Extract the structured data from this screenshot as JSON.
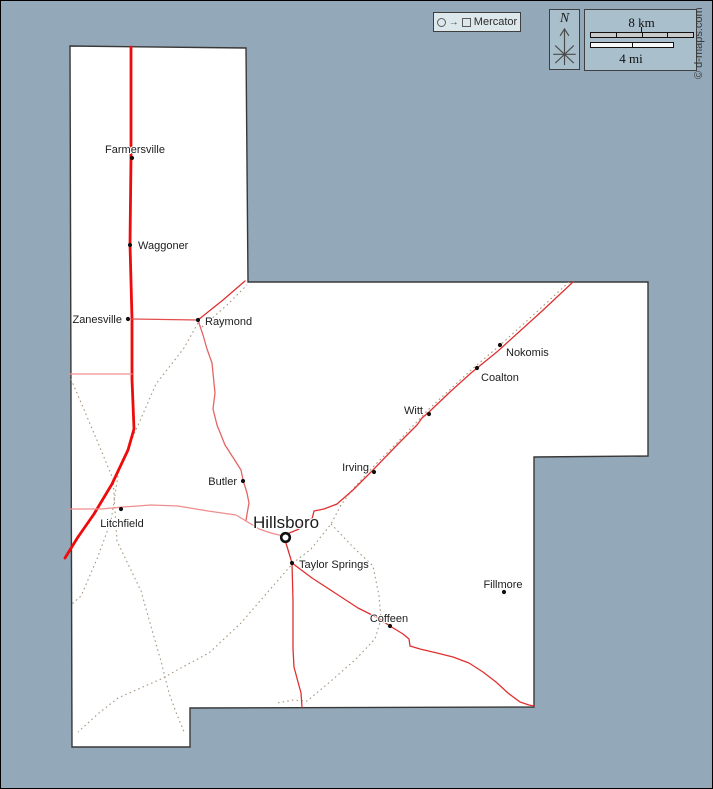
{
  "canvas": {
    "width": 713,
    "height": 789,
    "background": "#93a9b9",
    "frame_color": "#000000"
  },
  "header": {
    "projection_box": {
      "label": "Mercator",
      "icon": "circle-to-square-projection"
    },
    "compass": {
      "label": "N"
    },
    "scale": {
      "km_label": "8 km",
      "mi_label": "4 mi"
    },
    "credit": "© d-maps.com"
  },
  "map": {
    "county_fill": "#ffffff",
    "county_border_color": "#383838",
    "railroad_color": "#a8977f",
    "label_color": "#1c1c1c",
    "county_outline": [
      [
        69,
        45
      ],
      [
        245,
        47
      ],
      [
        247,
        281
      ],
      [
        647,
        281
      ],
      [
        647,
        455
      ],
      [
        533,
        456
      ],
      [
        533,
        706
      ],
      [
        189,
        707
      ],
      [
        189,
        746
      ],
      [
        71,
        746
      ]
    ],
    "roads": [
      {
        "id": "main-highway-north-south",
        "width": 2.8,
        "color": "#ed0b0b",
        "points": [
          [
            130,
            46
          ],
          [
            130,
            157
          ],
          [
            129,
            243
          ],
          [
            131,
            318
          ],
          [
            131,
            378
          ],
          [
            133,
            428
          ],
          [
            127,
            449
          ],
          [
            111,
            483
          ],
          [
            93,
            513
          ],
          [
            77,
            536
          ],
          [
            64,
            557
          ]
        ]
      },
      {
        "id": "west-connector",
        "width": 1.3,
        "color": "#ef9292",
        "points": [
          [
            68,
            373
          ],
          [
            131,
            373
          ]
        ]
      },
      {
        "id": "zanesville-raymond-road",
        "width": 1.3,
        "color": "#e34d4d",
        "points": [
          [
            131,
            318
          ],
          [
            197,
            319
          ]
        ]
      },
      {
        "id": "raymond-ne-stub",
        "width": 1.3,
        "color": "#e03030",
        "points": [
          [
            197,
            319
          ],
          [
            222,
            299
          ],
          [
            244,
            280
          ]
        ]
      },
      {
        "id": "raymond-butler-road",
        "width": 1.3,
        "color": "#e56464",
        "points": [
          [
            197,
            319
          ],
          [
            202,
            334
          ],
          [
            206,
            348
          ],
          [
            211,
            362
          ],
          [
            214,
            392
          ],
          [
            212,
            408
          ],
          [
            216,
            424
          ],
          [
            224,
            444
          ],
          [
            233,
            458
          ],
          [
            240,
            469
          ],
          [
            242,
            479
          ],
          [
            246,
            492
          ],
          [
            248,
            502
          ],
          [
            246,
            513
          ],
          [
            245,
            520
          ]
        ]
      },
      {
        "id": "litchfield-hillsboro-road",
        "width": 1.3,
        "color": "#ef8e8e",
        "points": [
          [
            68,
            508
          ],
          [
            100,
            508
          ],
          [
            122,
            506
          ],
          [
            150,
            504
          ],
          [
            177,
            505
          ],
          [
            207,
            510
          ],
          [
            235,
            514
          ],
          [
            245,
            520
          ],
          [
            258,
            528
          ],
          [
            270,
            532
          ],
          [
            282,
            535
          ]
        ]
      },
      {
        "id": "hillsboro-ne-link",
        "width": 1.3,
        "color": "#e03030",
        "points": [
          [
            286,
            533
          ],
          [
            298,
            528
          ],
          [
            301,
            521
          ],
          [
            311,
            518
          ],
          [
            313,
            510
          ],
          [
            323,
            508
          ],
          [
            336,
            503
          ]
        ]
      },
      {
        "id": "ne-diagonal-highway",
        "width": 1.3,
        "color": "#e03030",
        "points": [
          [
            336,
            503
          ],
          [
            352,
            489
          ],
          [
            371,
            470
          ],
          [
            398,
            442
          ],
          [
            416,
            424
          ],
          [
            421,
            417
          ],
          [
            428,
            411
          ],
          [
            449,
            391
          ],
          [
            470,
            372
          ],
          [
            497,
            350
          ],
          [
            540,
            311
          ],
          [
            572,
            281
          ]
        ]
      },
      {
        "id": "hillsboro-south-road",
        "width": 1.3,
        "color": "#e03030",
        "points": [
          [
            284,
            539
          ],
          [
            288,
            552
          ],
          [
            291,
            562
          ],
          [
            292,
            600
          ],
          [
            292,
            648
          ],
          [
            293,
            666
          ],
          [
            297,
            681
          ],
          [
            300,
            692
          ],
          [
            301,
            706
          ]
        ]
      },
      {
        "id": "taylor-springs-coffeen-road",
        "width": 1.3,
        "color": "#e03030",
        "points": [
          [
            291,
            562
          ],
          [
            311,
            577
          ],
          [
            331,
            590
          ],
          [
            357,
            607
          ],
          [
            377,
            617
          ],
          [
            389,
            625
          ],
          [
            402,
            633
          ],
          [
            408,
            638
          ],
          [
            409,
            645
          ],
          [
            419,
            648
          ],
          [
            436,
            652
          ],
          [
            452,
            656
          ],
          [
            468,
            662
          ],
          [
            482,
            671
          ],
          [
            495,
            681
          ],
          [
            507,
            692
          ],
          [
            519,
            701
          ],
          [
            528,
            704
          ],
          [
            533,
            705
          ]
        ]
      }
    ],
    "railroads": [
      {
        "id": "rr-raymond-southwest",
        "points": [
          [
            197,
            322
          ],
          [
            183,
            347
          ],
          [
            155,
            383
          ],
          [
            118,
            468
          ],
          [
            110,
            520
          ],
          [
            96,
            558
          ],
          [
            80,
            595
          ],
          [
            70,
            604
          ]
        ]
      },
      {
        "id": "rr-northwest-southeast",
        "points": [
          [
            70,
            378
          ],
          [
            95,
            437
          ],
          [
            112,
            478
          ],
          [
            116,
            540
          ],
          [
            140,
            590
          ],
          [
            153,
            636
          ],
          [
            160,
            660
          ],
          [
            168,
            692
          ],
          [
            176,
            714
          ],
          [
            184,
            733
          ]
        ]
      },
      {
        "id": "rr-raymond-northeast",
        "points": [
          [
            201,
            326
          ],
          [
            226,
            304
          ],
          [
            246,
            284
          ]
        ]
      },
      {
        "id": "rr-ne-mainline",
        "points": [
          [
            568,
            281
          ],
          [
            540,
            307
          ],
          [
            497,
            346
          ],
          [
            470,
            369
          ],
          [
            428,
            408
          ],
          [
            394,
            444
          ],
          [
            372,
            466
          ],
          [
            352,
            488
          ],
          [
            340,
            504
          ],
          [
            330,
            523
          ],
          [
            310,
            548
          ],
          [
            292,
            562
          ],
          [
            272,
            585
          ],
          [
            240,
            622
          ],
          [
            208,
            652
          ],
          [
            178,
            668
          ],
          [
            160,
            678
          ],
          [
            117,
            697
          ],
          [
            98,
            712
          ],
          [
            77,
            731
          ]
        ]
      },
      {
        "id": "rr-coffeen-branch",
        "points": [
          [
            330,
            523
          ],
          [
            352,
            546
          ],
          [
            372,
            565
          ],
          [
            378,
            595
          ],
          [
            380,
            618
          ],
          [
            374,
            638
          ],
          [
            355,
            658
          ],
          [
            330,
            680
          ],
          [
            306,
            700
          ],
          [
            292,
            699
          ],
          [
            276,
            702
          ]
        ]
      }
    ],
    "cities": [
      {
        "name": "Farmersville",
        "x": 131,
        "y": 157,
        "label_x": 134,
        "label_y": 152,
        "anchor": "middle"
      },
      {
        "name": "Waggoner",
        "x": 129,
        "y": 244,
        "label_x": 137,
        "label_y": 248,
        "anchor": "start"
      },
      {
        "name": "Zanesville",
        "x": 127,
        "y": 318,
        "label_x": 121,
        "label_y": 322,
        "anchor": "end"
      },
      {
        "name": "Raymond",
        "x": 197,
        "y": 319,
        "label_x": 204,
        "label_y": 324,
        "anchor": "start"
      },
      {
        "name": "Nokomis",
        "x": 499,
        "y": 344,
        "label_x": 505,
        "label_y": 355,
        "anchor": "start"
      },
      {
        "name": "Coalton",
        "x": 476,
        "y": 367,
        "label_x": 480,
        "label_y": 380,
        "anchor": "start"
      },
      {
        "name": "Witt",
        "x": 428,
        "y": 413,
        "label_x": 422,
        "label_y": 413,
        "anchor": "end"
      },
      {
        "name": "Irving",
        "x": 373,
        "y": 471,
        "label_x": 368,
        "label_y": 470,
        "anchor": "end"
      },
      {
        "name": "Butler",
        "x": 242,
        "y": 480,
        "label_x": 236,
        "label_y": 484,
        "anchor": "end"
      },
      {
        "name": "Litchfield",
        "x": 120,
        "y": 508,
        "label_x": 121,
        "label_y": 526,
        "anchor": "middle"
      },
      {
        "name": "Hillsboro",
        "x": 284.5,
        "y": 536.5,
        "label_x": 252,
        "label_y": 527,
        "anchor": "start",
        "marker": "ring",
        "font_size": 17
      },
      {
        "name": "Taylor Springs",
        "x": 291,
        "y": 562,
        "label_x": 298,
        "label_y": 567,
        "anchor": "start"
      },
      {
        "name": "Coffeen",
        "x": 389,
        "y": 625,
        "label_x": 388,
        "label_y": 621,
        "anchor": "middle"
      },
      {
        "name": "Fillmore",
        "x": 503,
        "y": 591,
        "label_x": 502,
        "label_y": 587,
        "anchor": "middle"
      }
    ]
  }
}
